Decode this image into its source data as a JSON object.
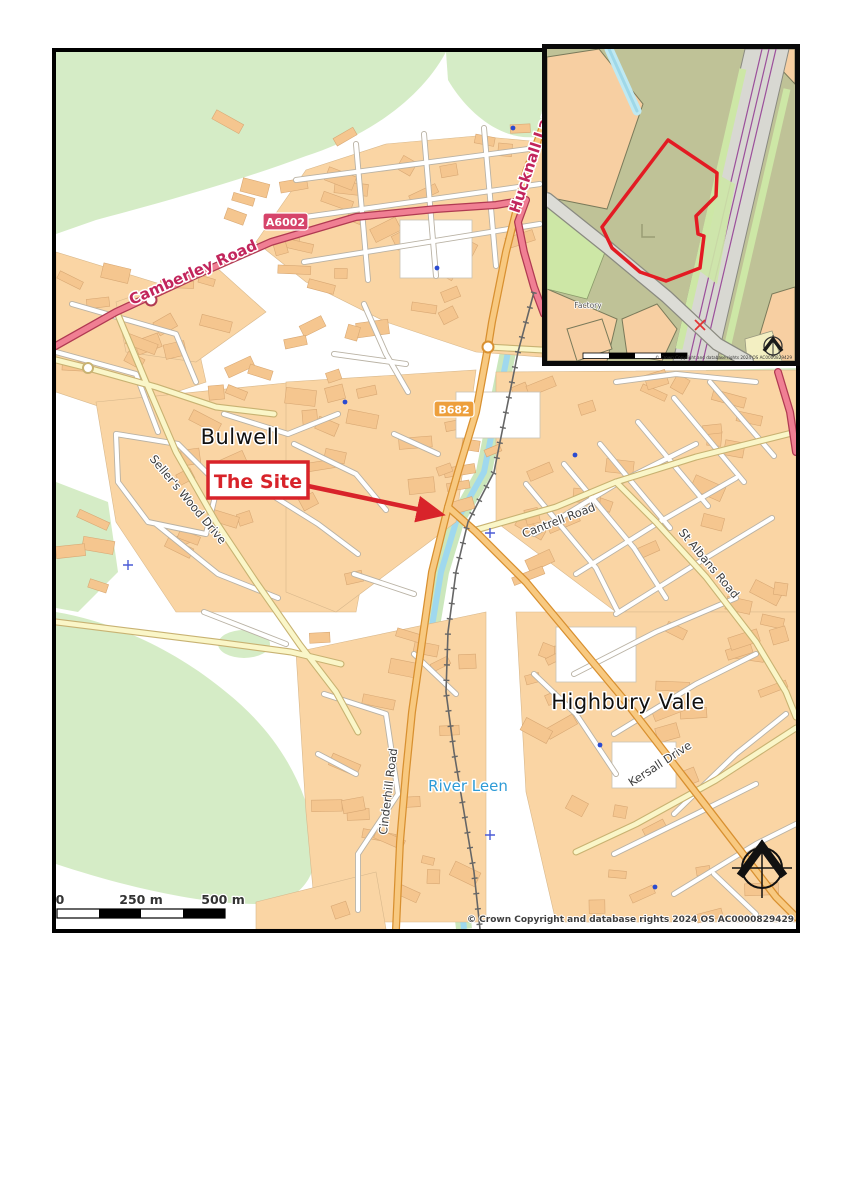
{
  "main_map": {
    "place_labels": {
      "bulwell": "Bulwell",
      "highbury_vale": "Highbury Vale"
    },
    "road_labels": {
      "camberley_road": "Camberley Road",
      "hucknall_lane": "Hucknall Lane",
      "sellers_wood_drive": "Seller's Wood Drive",
      "cinderhill_road": "Cinderhill Road",
      "cantrell_road": "Cantrell Road",
      "st_albans_road": "St Albans Road",
      "kersall_drive": "Kersall Drive"
    },
    "water_labels": {
      "river_leen": "River Leen"
    },
    "route_badges": {
      "a6002": "A6002",
      "b682": "B682"
    },
    "site_callout": {
      "label": "The Site"
    },
    "scale_bar": {
      "zero": "0",
      "mid": "250 m",
      "end": "500 m"
    },
    "copyright": "© Crown Copyright and database rights 2024 OS AC0000829429",
    "colors": {
      "a_road": "#F07F93",
      "b_road": "#F8C980",
      "minor_road": "#FAF6C8",
      "building": "#FAD5A4",
      "greenspace": "#D5ECC6",
      "water": "#9FD8EE",
      "site_red": "#D8232A",
      "badge_a": "#D6446A",
      "badge_b": "#ED9F3C"
    }
  },
  "inset_map": {
    "factory_label": "Factory",
    "copyright": "© Crown Copyright and database rights 2024 OS AC0000829429",
    "colors": {
      "site_area": "#BFC297",
      "parcel": "#F7CFA2",
      "grass": "#CDE7A6",
      "road": "#DCDCD6",
      "rail_line": "#9B4F9B",
      "boundary_red": "#E31B23"
    }
  }
}
